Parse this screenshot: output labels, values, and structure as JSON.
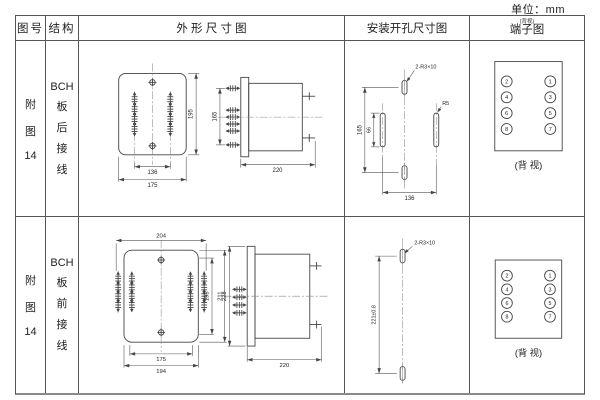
{
  "unit_label": "单位：mm",
  "header": {
    "fig_no": "图号",
    "structure": "结构",
    "outline": "外 形 尺 寸 图",
    "install": "安装开孔尺寸图",
    "terminal": "端子图",
    "terminal_note": "(背视)"
  },
  "rows": [
    {
      "fig_no": [
        "附",
        "图",
        "14"
      ],
      "structure": [
        "BCH",
        "板",
        "后",
        "接",
        "线"
      ],
      "outline": {
        "front_inner_width": "136",
        "front_outer_width": "175",
        "front_height": "195",
        "side_span": "165",
        "side_depth": "220"
      },
      "install": {
        "slot_label": "2-R3×10",
        "height": "165",
        "slot_length": "66",
        "width": "136",
        "radius_label": "R5"
      },
      "terminal": {
        "left": [
          "2",
          "4",
          "6",
          "8"
        ],
        "right": [
          "1",
          "3",
          "5",
          "7"
        ],
        "caption": "(背 视)"
      }
    },
    {
      "fig_no": [
        "附",
        "图",
        "14"
      ],
      "structure": [
        "BCH",
        "板",
        "前",
        "接",
        "线"
      ],
      "outline": {
        "front_top_width": "204",
        "front_height_inner": "195",
        "front_height_outer": "211",
        "front_inner_width": "175",
        "front_outer_width": "194",
        "side_height": "228",
        "side_depth": "220"
      },
      "install": {
        "slot_label": "2-R3×10",
        "height": "221±0.8"
      },
      "terminal": {
        "left": [
          "2",
          "4",
          "6",
          "8"
        ],
        "right": [
          "1",
          "3",
          "5",
          "7"
        ],
        "caption": "(背 视)"
      }
    }
  ]
}
